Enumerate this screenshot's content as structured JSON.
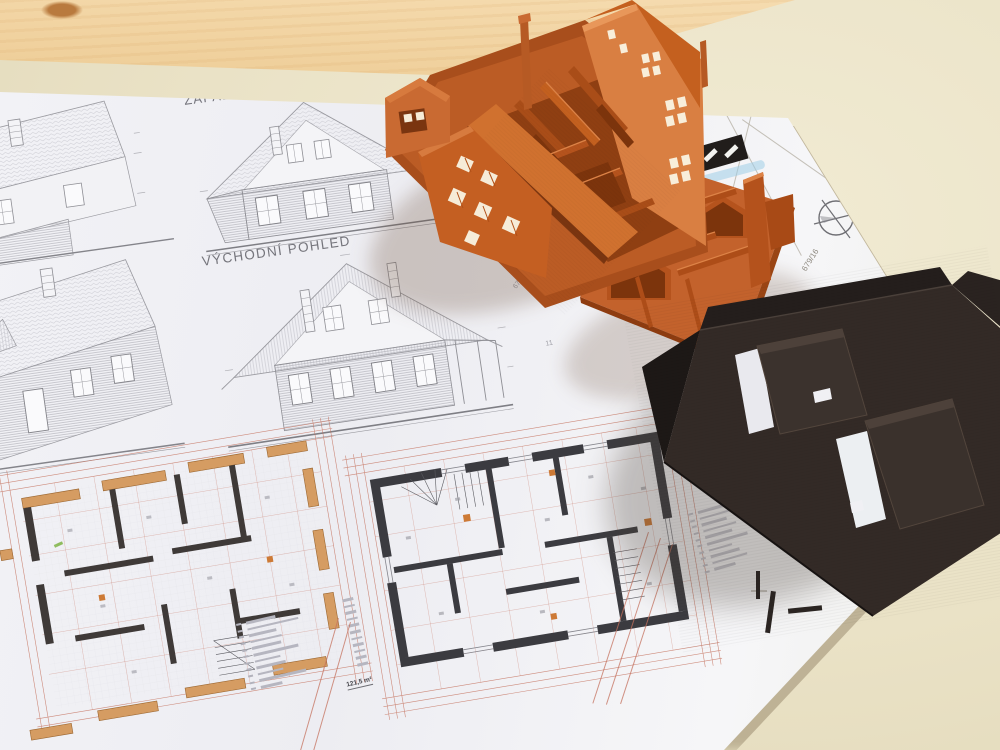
{
  "photo": {
    "labels": {
      "west_view": "ZÁPADNÍ POHLED",
      "east_view": "VÝCHODNÍ POHLED"
    },
    "annotations": {
      "total_area": "121,5 m²",
      "parcel_number": "679/16",
      "dim_a": "67",
      "dim_b": "11"
    },
    "colors": {
      "desk": "#eae2c6",
      "wood": "#f2d5a6",
      "paper": "#f3f3f7",
      "print_orange": "#c4622d",
      "print_dark": "#2e2724",
      "plan_wall": "#3b3b40",
      "plan_timber": "#d59c62",
      "dimension_red": "#c4705c",
      "highlighter_blue": "#a9cfe4",
      "mark_green": "#7cb342"
    }
  }
}
